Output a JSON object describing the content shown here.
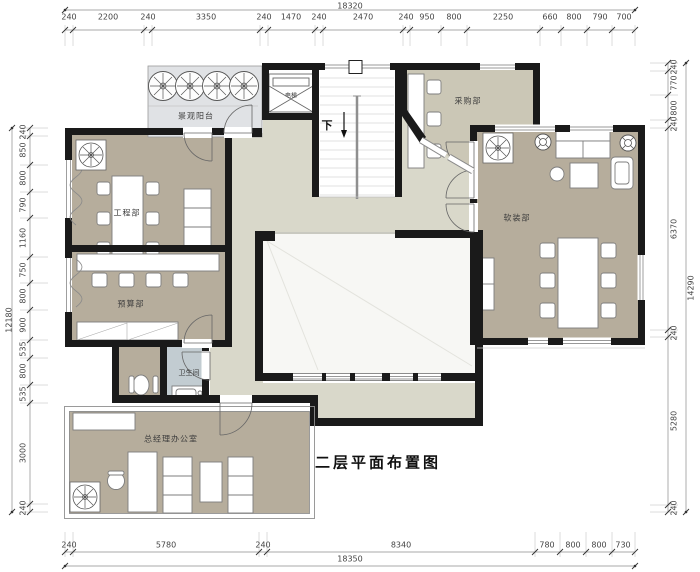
{
  "title": "二层平面布置图",
  "rooms": {
    "balcony": "景观阳台",
    "elevator": "电梯",
    "stairs_down": "下",
    "purchasing": "采购部",
    "soft_deco": "软装部",
    "engineering": "工程部",
    "budget": "预算部",
    "bathroom": "卫生间",
    "gm_office": "总经理办公室"
  },
  "dimensions": {
    "top": {
      "overall": "18320",
      "segments": [
        "240",
        "2200",
        "240",
        "3350",
        "240",
        "1470",
        "240",
        "2470",
        "240",
        "950",
        "800",
        "2250",
        "660",
        "800",
        "790",
        "700"
      ]
    },
    "bottom": {
      "overall": "18350",
      "segments": [
        "240",
        "5780",
        "240",
        "8340",
        "780",
        "800",
        "800",
        "730"
      ]
    },
    "left": {
      "overall": "12180",
      "segments": [
        "240",
        "850",
        "800",
        "790",
        "1160",
        "750",
        "800",
        "900",
        "535",
        "800",
        "535",
        "3000",
        "240"
      ]
    },
    "right": {
      "overall": "14290",
      "segments": [
        "240",
        "770",
        "800",
        "240",
        "6370",
        "240",
        "5280",
        "240"
      ]
    }
  },
  "colors": {
    "wall": "#1a1a1a",
    "room_fill": "#b6ad9c",
    "purchasing_fill": "#cbc7b6",
    "corridor_fill": "#d9d8ca",
    "balcony_fill": "#e0e2e5",
    "bathroom_fill": "#c2ccd1",
    "void_fill": "#f7f7f4"
  }
}
